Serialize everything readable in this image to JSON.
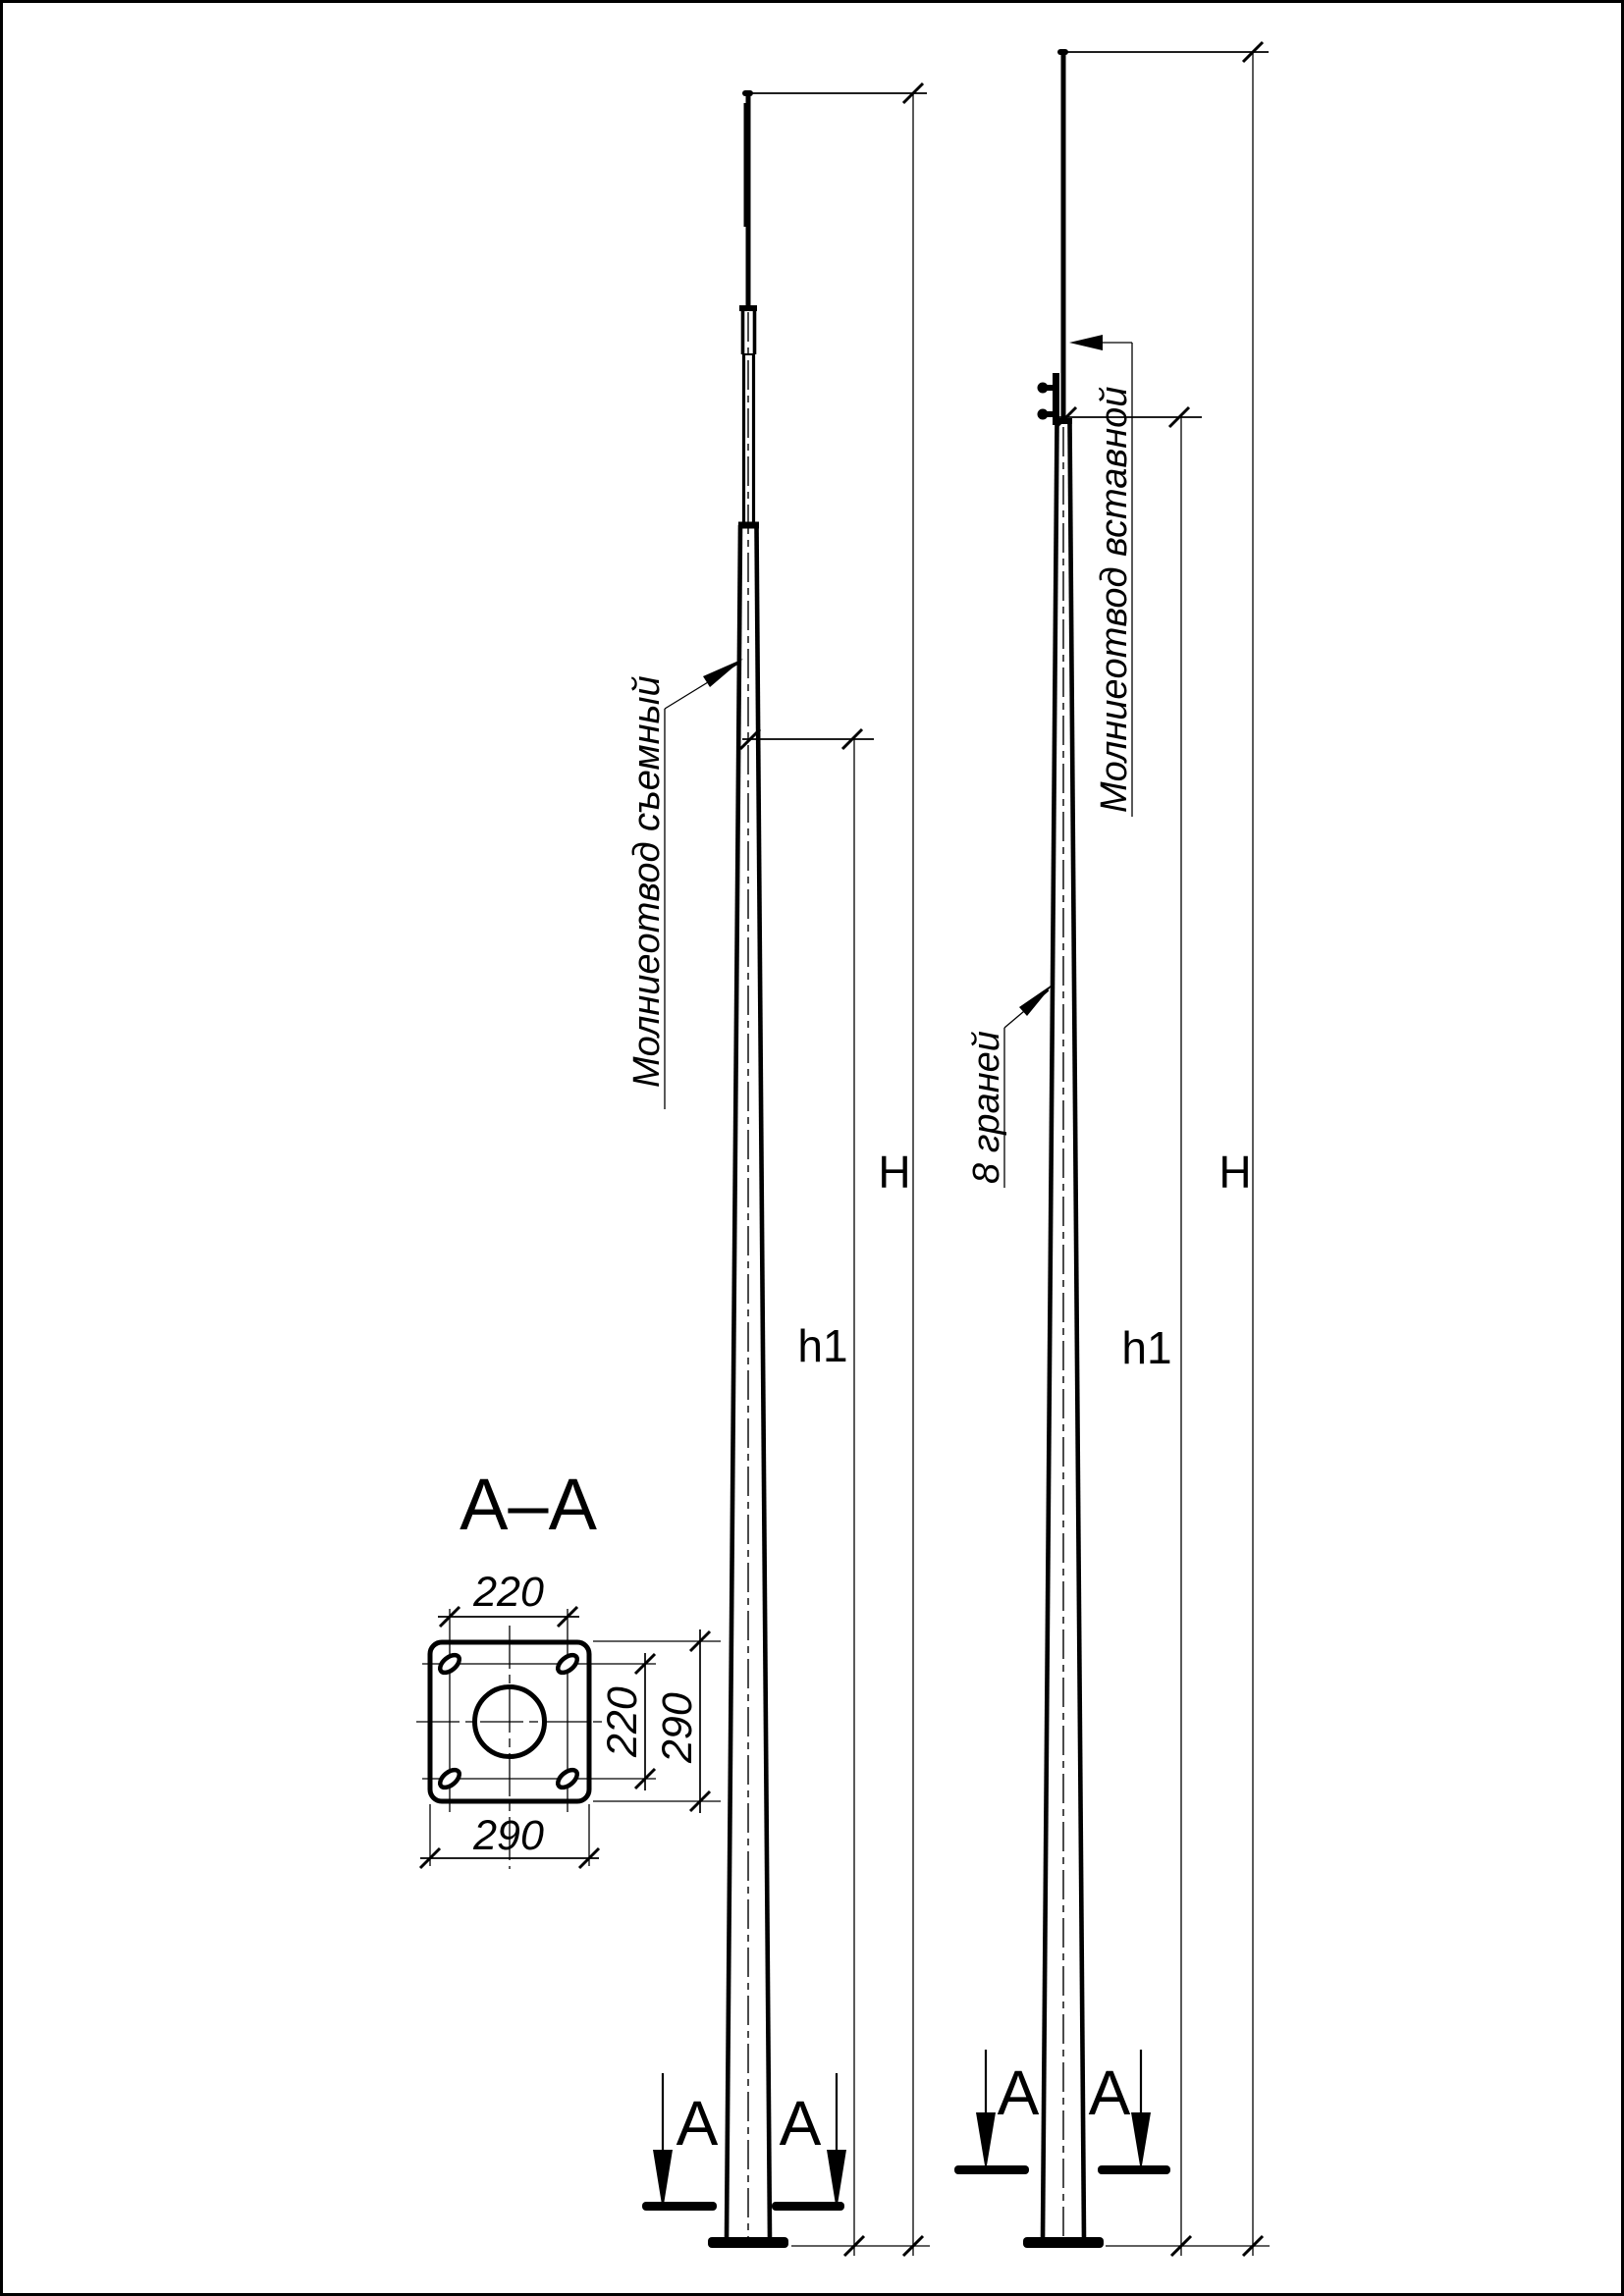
{
  "drawing": {
    "section_title": "А–А",
    "labels": {
      "removable_rod": "Молниеотвод съемный",
      "insert_rod": "Молниеотвод вставной",
      "facets": "8 граней"
    },
    "dims": {
      "H": "H",
      "h1": "h1",
      "plate_hole_span": "220",
      "plate_width": "290"
    },
    "section_marker": "А",
    "colors": {
      "ink": "#000000",
      "paper": "#ffffff"
    }
  }
}
